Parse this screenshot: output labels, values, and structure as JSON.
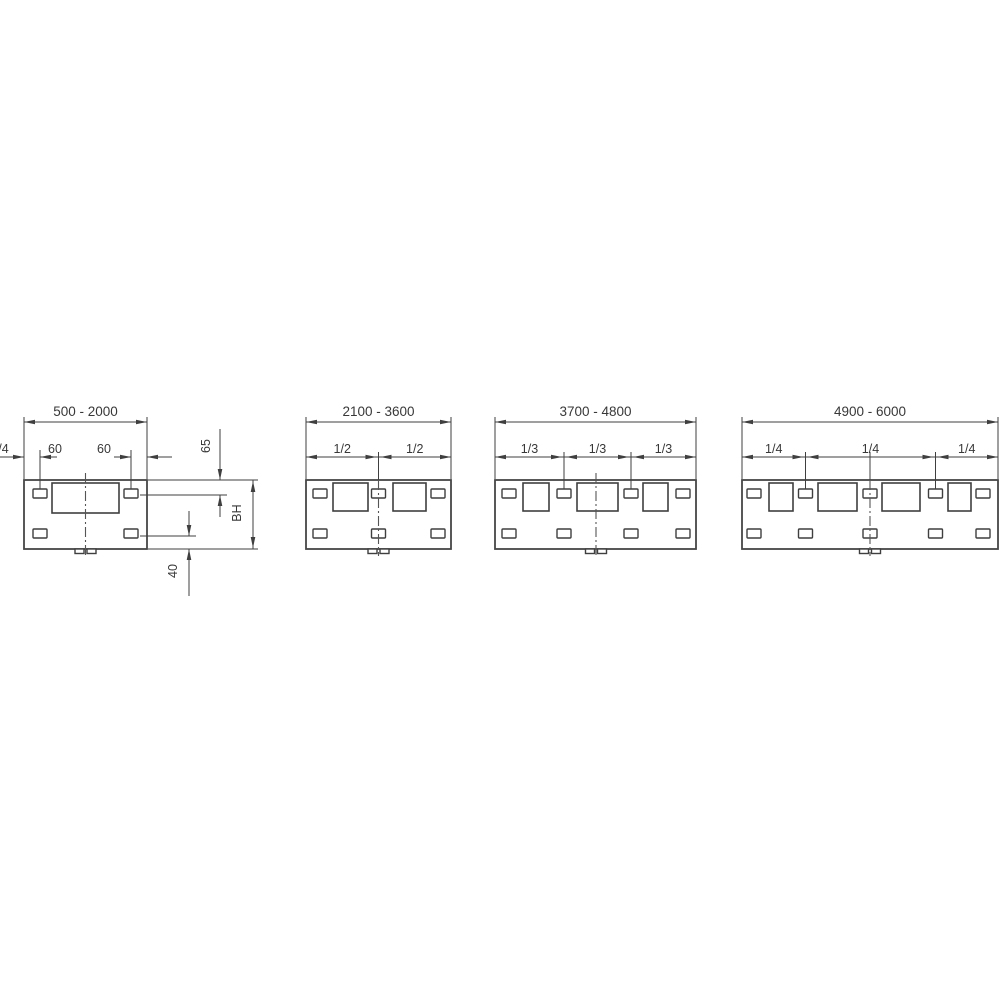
{
  "drawing": {
    "description": "Technical dimension diagram of four mounting panels for increasing width ranges",
    "background": "#ffffff",
    "line_color": "#3f3f3f",
    "text_color": "#383838",
    "layout": {
      "body_top": 480,
      "body_bottom": 549,
      "window_top": 483,
      "window_bottom": 511,
      "slot_top_y": 489,
      "slot_bottom_y": 529,
      "slot_w": 14,
      "slot_h": 9,
      "main_dim_y": 422,
      "main_ext_top": 417,
      "main_label_y": 416,
      "sub_dim_y": 457,
      "sub_ext_top": 450,
      "sub_label_y": 453,
      "center_line_bottom": 556,
      "tab_w": 9,
      "tab_h": 4.5
    },
    "panels": [
      {
        "name": "width-500-2000",
        "range_label": "500 - 2000",
        "body": [
          24,
          147
        ],
        "windows": [
          [
            52,
            119
          ]
        ],
        "window_bottom": 513,
        "slot_centers": [
          40,
          131
        ],
        "center_x": 85.5,
        "center_from_dim": false,
        "sub_dims": {
          "style": "outside",
          "tails": [
            [
              0,
              24
            ],
            [
              40,
              57
            ],
            [
              114,
              131
            ],
            [
              147,
              172
            ]
          ],
          "arrows": [
            {
              "x": 24,
              "dir": "right"
            },
            {
              "x": 40,
              "dir": "left"
            },
            {
              "x": 131,
              "dir": "right"
            },
            {
              "x": 147,
              "dir": "left"
            }
          ],
          "ext_x": [
            40,
            131
          ],
          "labels": [
            {
              "text": "60",
              "x": 55
            },
            {
              "text": "60",
              "x": 104
            }
          ]
        }
      },
      {
        "name": "width-2100-3600",
        "range_label": "2100 - 3600",
        "body": [
          306,
          451
        ],
        "windows": [
          [
            333,
            368
          ],
          [
            393,
            426
          ]
        ],
        "slot_centers": [
          320,
          378.5,
          438
        ],
        "center_x": 378.5,
        "center_from_dim": true,
        "sub_dims": {
          "style": "chain",
          "boundaries": [
            378.5
          ],
          "labels": [
            "1/2",
            "1/2"
          ]
        }
      },
      {
        "name": "width-3700-4800",
        "range_label": "3700 - 4800",
        "body": [
          495,
          696
        ],
        "windows": [
          [
            523,
            549
          ],
          [
            577,
            618
          ],
          [
            643,
            668
          ]
        ],
        "slot_centers": [
          509,
          564,
          631,
          683
        ],
        "center_x": 596,
        "center_from_dim": false,
        "sub_dims": {
          "style": "chain",
          "boundaries": [
            564,
            631
          ],
          "labels": [
            "1/3",
            "1/3",
            "1/3"
          ]
        }
      },
      {
        "name": "width-4900-6000",
        "range_label": "4900 - 6000",
        "body": [
          742,
          998
        ],
        "windows": [
          [
            769,
            793
          ],
          [
            818,
            857
          ],
          [
            882,
            920
          ],
          [
            948,
            971
          ]
        ],
        "slot_centers": [
          754,
          805.5,
          870,
          935.5,
          983
        ],
        "center_x": 870,
        "center_from_dim": true,
        "sub_dims": {
          "style": "chain",
          "boundaries": [
            805.5,
            935.5
          ],
          "labels": [
            "1/4",
            "1/4",
            "1/4",
            "1/4"
          ]
        }
      }
    ],
    "side_dims": {
      "ext_lines": [
        [
          148,
          480,
          258,
          480
        ],
        [
          140,
          495,
          227,
          495
        ],
        [
          140,
          536,
          196,
          536
        ],
        [
          148,
          549,
          258,
          549
        ]
      ],
      "dims": [
        {
          "label": "65",
          "x": 220,
          "segments": [
            [
              429,
              480
            ],
            [
              495,
              517
            ]
          ],
          "arrows": [
            {
              "y": 480,
              "dir": "down"
            },
            {
              "y": 495,
              "dir": "up"
            }
          ],
          "label_pos": [
            210,
            446
          ]
        },
        {
          "label": "BH",
          "x": 253,
          "segments": [
            [
              480,
              549
            ]
          ],
          "arrows": [
            {
              "y": 481,
              "dir": "up"
            },
            {
              "y": 548,
              "dir": "down"
            }
          ],
          "label_pos": [
            241,
            513
          ]
        },
        {
          "label": "40",
          "x": 189,
          "segments": [
            [
              511,
              536
            ],
            [
              549,
              596
            ]
          ],
          "arrows": [
            {
              "y": 536,
              "dir": "down"
            },
            {
              "y": 549,
              "dir": "up"
            }
          ],
          "label_pos": [
            177,
            571
          ]
        }
      ]
    }
  }
}
